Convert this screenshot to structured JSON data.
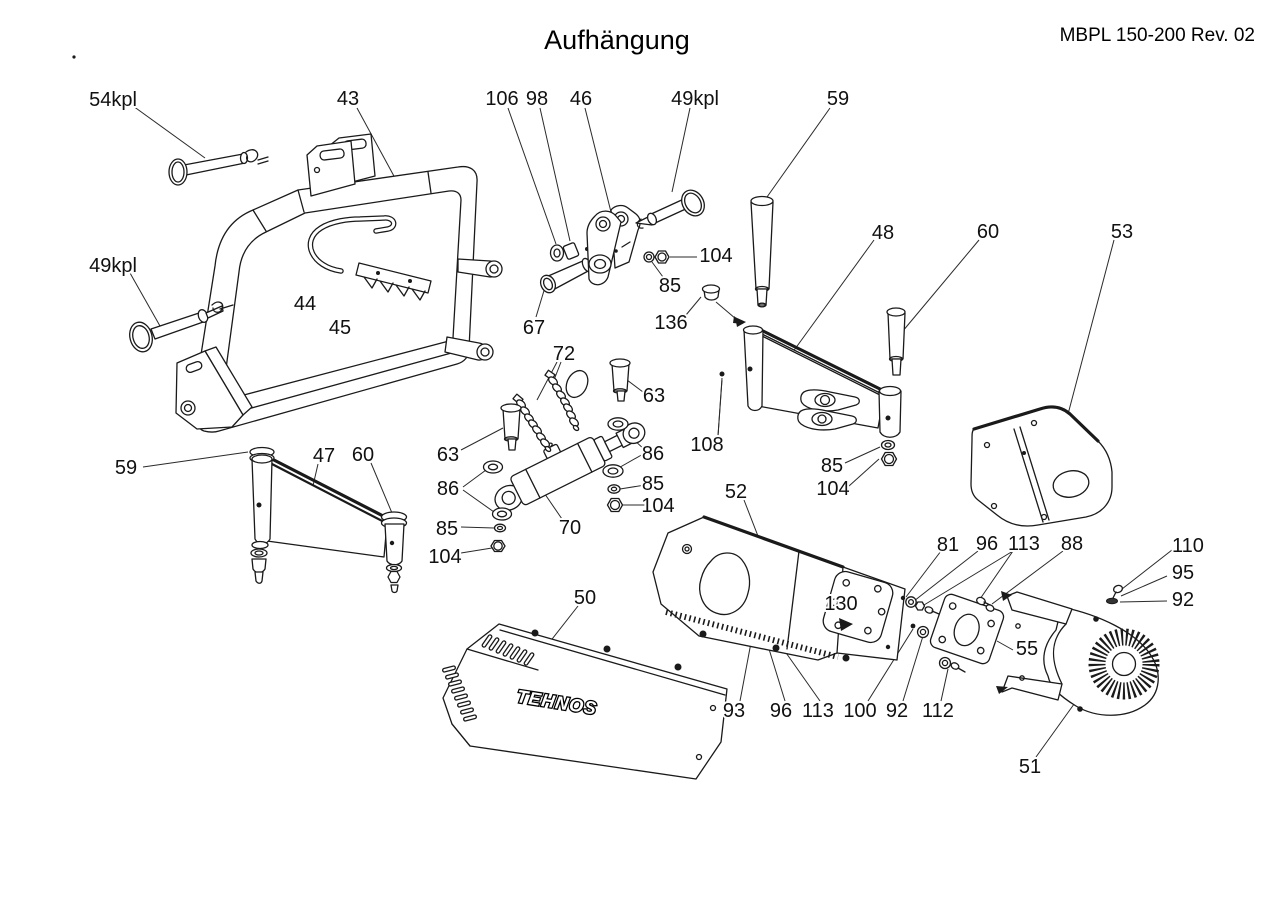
{
  "page": {
    "title": "Aufhängung",
    "doc_ref": "MBPL 150-200 Rev. 02",
    "background": "#ffffff",
    "line_color": "#1a1a1a"
  },
  "drawing": {
    "type": "exploded-parts-diagram",
    "brand_logo": "TEHNOS"
  },
  "callouts": [
    {
      "text": "54kpl"
    },
    {
      "text": "43"
    },
    {
      "text": "106"
    },
    {
      "text": "98"
    },
    {
      "text": "46"
    },
    {
      "text": "49kpl"
    },
    {
      "text": "59"
    },
    {
      "text": "48"
    },
    {
      "text": "60"
    },
    {
      "text": "53"
    },
    {
      "text": "49kpl"
    },
    {
      "text": "44"
    },
    {
      "text": "45"
    },
    {
      "text": "67"
    },
    {
      "text": "104"
    },
    {
      "text": "85"
    },
    {
      "text": "136"
    },
    {
      "text": "72"
    },
    {
      "text": "63"
    },
    {
      "text": "108"
    },
    {
      "text": "85"
    },
    {
      "text": "104"
    },
    {
      "text": "59"
    },
    {
      "text": "47"
    },
    {
      "text": "60"
    },
    {
      "text": "63"
    },
    {
      "text": "86"
    },
    {
      "text": "85"
    },
    {
      "text": "104"
    },
    {
      "text": "70"
    },
    {
      "text": "86"
    },
    {
      "text": "85"
    },
    {
      "text": "104"
    },
    {
      "text": "52"
    },
    {
      "text": "50"
    },
    {
      "text": "130"
    },
    {
      "text": "81"
    },
    {
      "text": "96"
    },
    {
      "text": "113"
    },
    {
      "text": "88"
    },
    {
      "text": "110"
    },
    {
      "text": "95"
    },
    {
      "text": "92"
    },
    {
      "text": "55"
    },
    {
      "text": "93"
    },
    {
      "text": "96"
    },
    {
      "text": "113"
    },
    {
      "text": "100"
    },
    {
      "text": "92"
    },
    {
      "text": "112"
    },
    {
      "text": "51"
    }
  ]
}
